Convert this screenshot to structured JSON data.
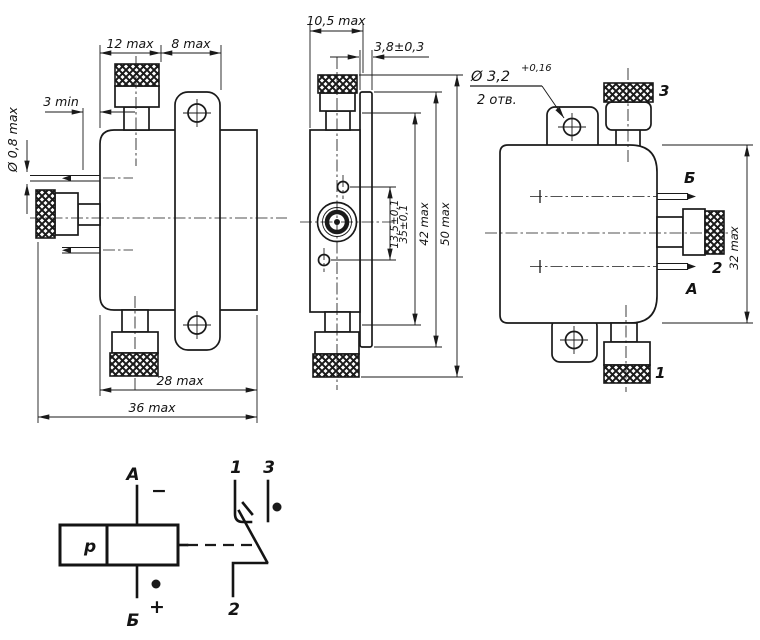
{
  "front_view": {
    "dim_12": "12 max",
    "dim_8": "8 max",
    "dim_3min": "3 min",
    "dim_d08": "Ø 0,8 max",
    "dim_28": "28 max",
    "dim_36": "36 max"
  },
  "side_view": {
    "dim_105": "10,5 max",
    "dim_38": "3,8±0,3",
    "dim_135": "13,5±0,1",
    "dim_35": "35±0,1",
    "dim_42": "42 max",
    "dim_50": "50 max"
  },
  "back_view": {
    "dim_32": "32 max",
    "hole_dia": "Ø 3,2",
    "hole_tol": "+0,16",
    "hole_qty": "2 отв.",
    "pin_top_label": "Б",
    "pin_bottom_label": "А",
    "pin_number": "2",
    "knob_top_label": "3",
    "knob_bottom_label": "1"
  },
  "schematic": {
    "coil_label": "р",
    "terminal_a": "А",
    "terminal_b": "Б",
    "sign_minus": "−",
    "sign_plus": "+",
    "contact_1": "1",
    "contact_2": "2",
    "contact_3": "3"
  }
}
